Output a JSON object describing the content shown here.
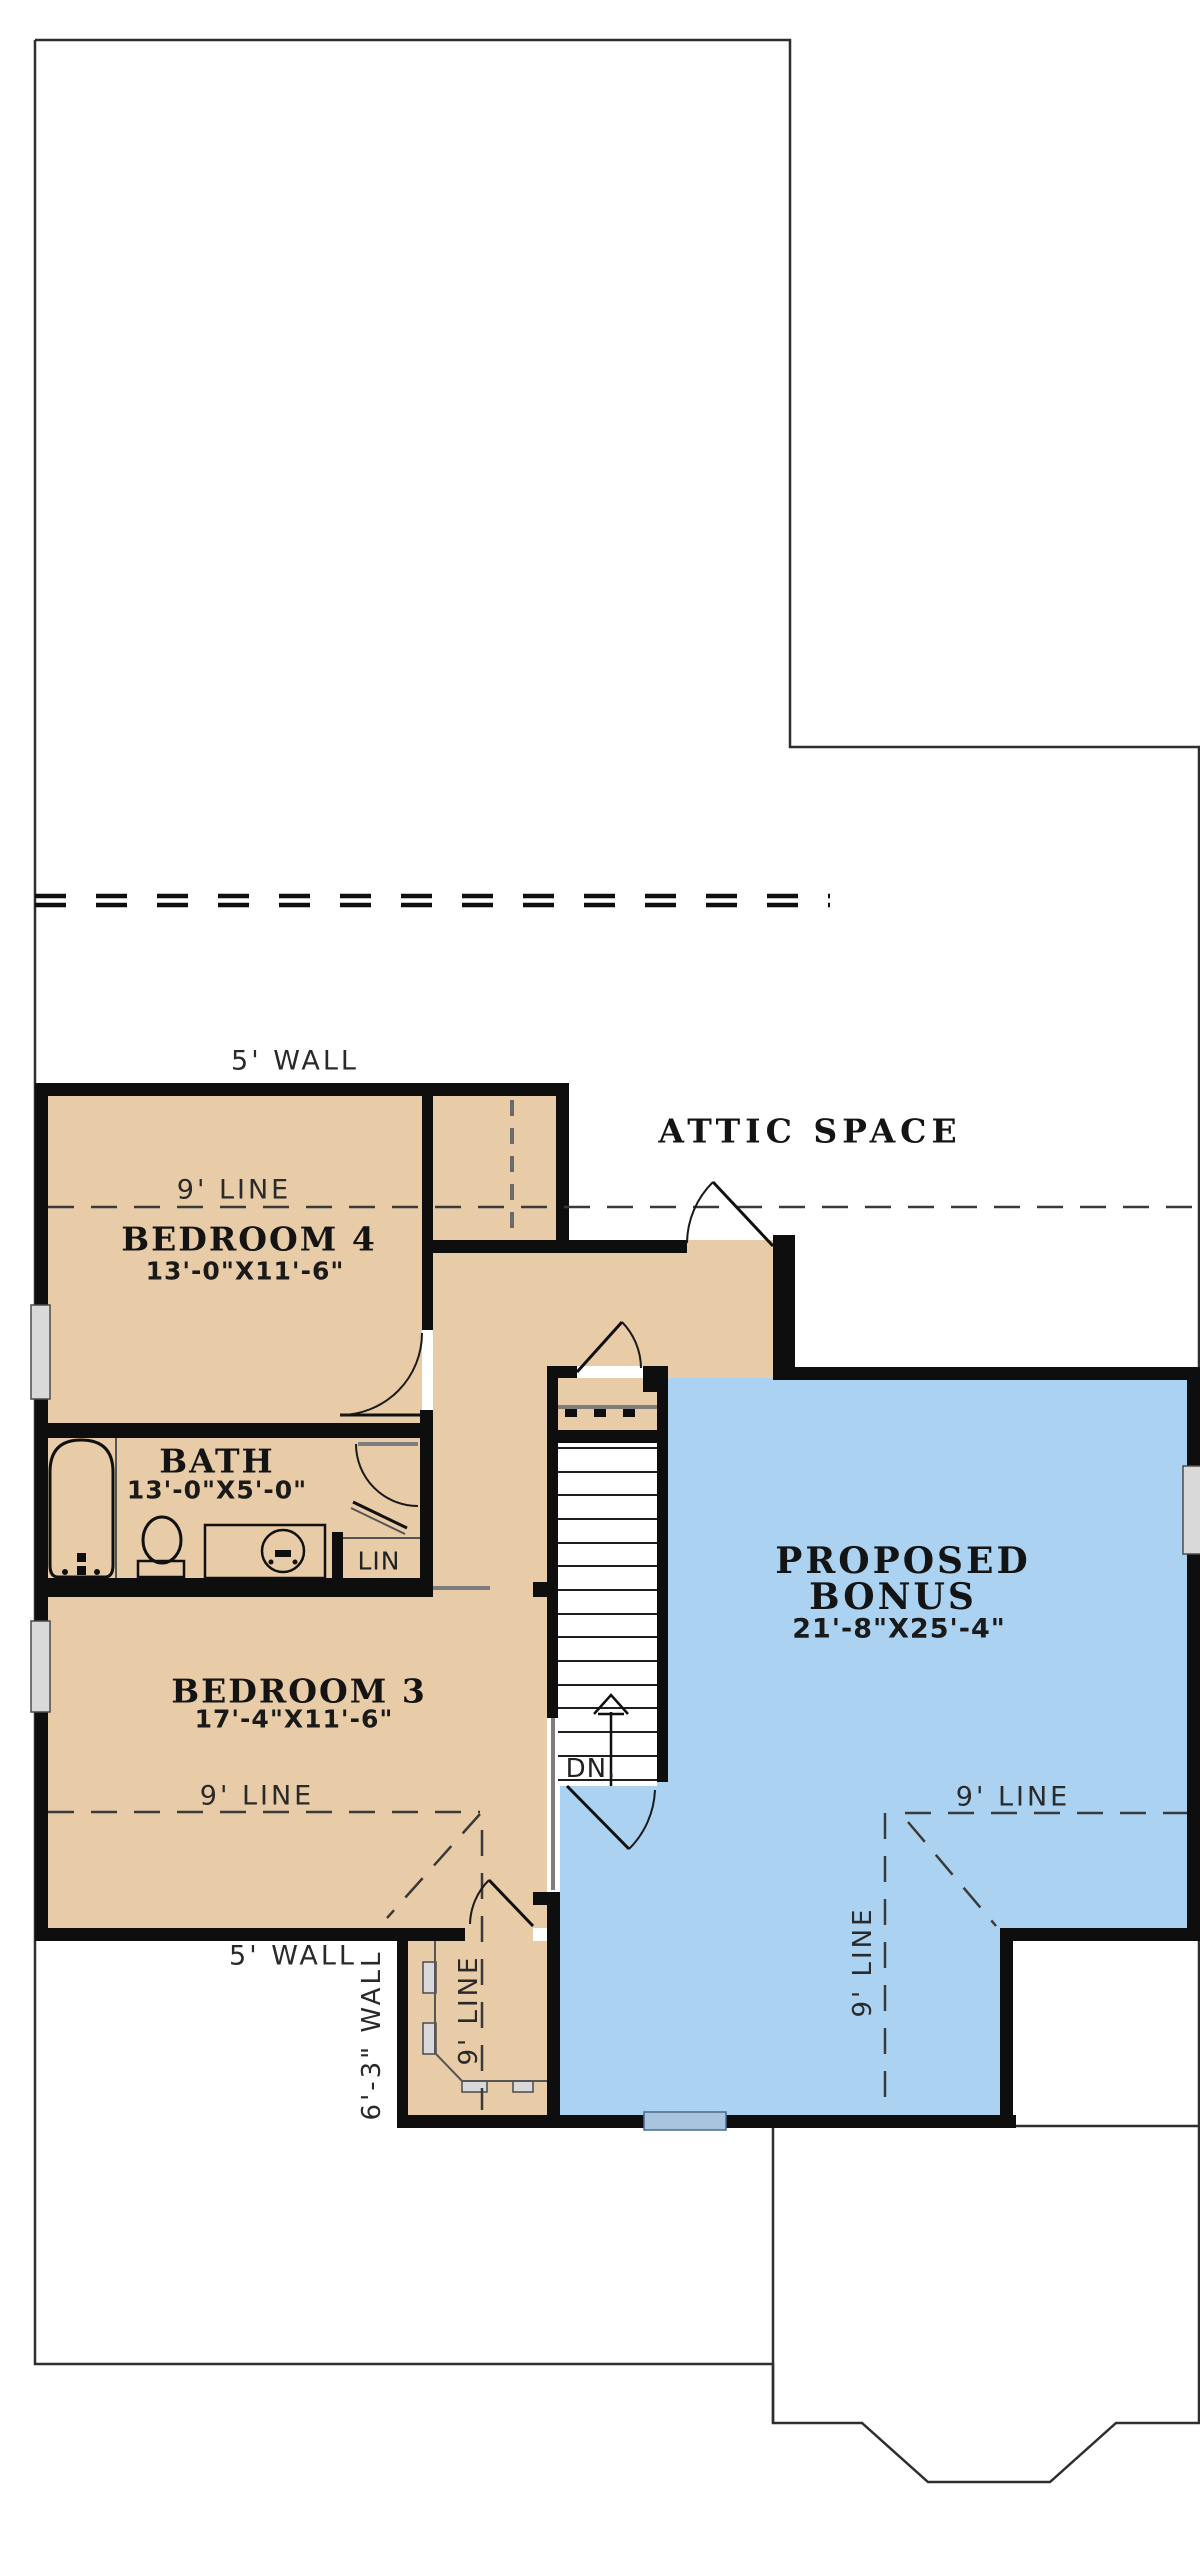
{
  "colors": {
    "tan": "#e8cba7",
    "blue": "#abd3f1",
    "wall": "#0e0e0e",
    "line": "#2e2e2e",
    "gray": "#7d7d7d",
    "window": "#d9d9d9",
    "window_blue": "#a9c4de"
  },
  "labels": {
    "attic_space": "ATTIC SPACE",
    "wall5_top": "5' WALL",
    "line9_attic": "9' LINE",
    "bedroom4": {
      "name": "BEDROOM 4",
      "dims": "13'-0\"X11'-6\""
    },
    "bath": {
      "name": "BATH",
      "dims": "13'-0\"X5'-0\""
    },
    "lin": "LIN",
    "bedroom3": {
      "name": "BEDROOM 3",
      "dims": "17'-4\"X11'-6\""
    },
    "line9_bedroom3": "9' LINE",
    "bonus": {
      "name_line1": "PROPOSED",
      "name_line2": "BONUS",
      "dims": "21'-8\"X25'-4\""
    },
    "line9_bonus": "9' LINE",
    "line9_vestibule": "9' LINE",
    "dn": "DN.",
    "wall5_bottom": "5' WALL",
    "wall63": "6'-3\" WALL"
  }
}
